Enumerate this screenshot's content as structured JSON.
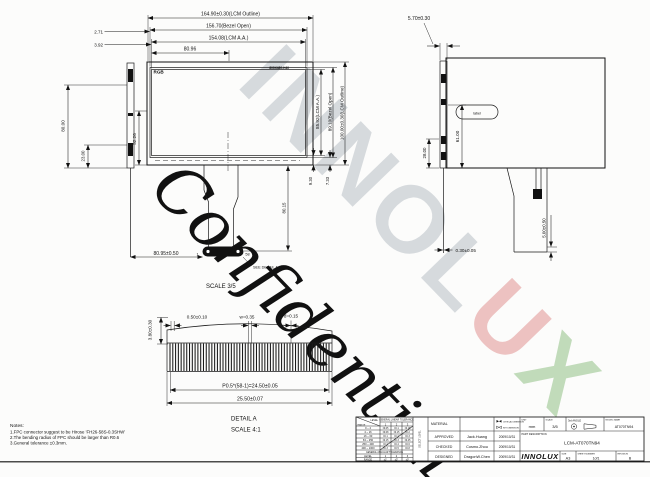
{
  "watermark": {
    "logo_part1": "INNOL",
    "logo_part2": "U",
    "logo_part3": "X",
    "confidential": "Confidential",
    "gray": "rgba(158,168,178,0.40)",
    "red": "rgba(210,85,85,0.35)",
    "green": "rgba(105,170,90,0.40)",
    "cyan": "rgba(92,170,202,0.55)"
  },
  "front_view": {
    "rgb_label": "RGB",
    "corner_marking": "800X480-H40",
    "dim_outline_w": "164.90±0.30(LCM Outline)",
    "dim_bezel_w": "156.70(Bezel Open)",
    "dim_aa_w": "154.08(LCM A.A.)",
    "dim_center": "80.96",
    "dim_bezel_left": "2.71",
    "dim_aa_left": "3.92",
    "dim_aa_h": "85.92(LCM A.A.)",
    "dim_bezel_h": "89.10(Bezel Open)",
    "dim_outline_h": "100.00±0.30(LCM Outline)",
    "dim_aa_bottom": "9.30",
    "dim_bezel_bottom": "7.33",
    "dim_left_v": "52.26",
    "dim_fpc_x": "80.95±0.50",
    "dim_fpc_len": "80.15",
    "pin_first": "1",
    "pin_last": "58",
    "see_detail": "SEE DETAIL A",
    "scale_note": "SCALE  3/5"
  },
  "side_left": {
    "dim_height": "80.00",
    "dim_lower": "23.00"
  },
  "side_right": {
    "dim_thickness": "5.70±0.30",
    "dim_upper": "61.00",
    "dim_lower": "28.00",
    "dim_fpc_t": "0.30±0.05"
  },
  "rear_view": {
    "badge_text": "label",
    "dim_fpc_bottom": "5.00±0.50"
  },
  "detail_a": {
    "pin_count": 58,
    "dim_height": "3.80±0.30",
    "dim_first": "0.50±0.10",
    "dim_width": "w=0.35",
    "dim_gap": "d=0.15",
    "dim_pitch": "P0.5*(58-1)=24.50±0.05",
    "dim_total": "25.50±0.07",
    "title": "DETAIL  A",
    "scale_note": "SCALE  4:1"
  },
  "notes": {
    "title": "Notes:",
    "lines": [
      "1.FPC connector suggest to be Hirose 'FH26-58S-0.3SHW'",
      "2.The bending radius of FPC should be larger than R0.6",
      "3.General tolerance ±0.3mm."
    ]
  },
  "title_block": {
    "material_label": "MATERIAL",
    "critical_label": "CRITICAL DIMENSION",
    "key_label": "KEY DIMENSION",
    "rows": [
      {
        "role": "APPROVED",
        "name": "Jack.Huang",
        "date": "2009/10/31"
      },
      {
        "role": "CHECKED",
        "name": "Cosmo.Zhou",
        "date": "2009/10/31"
      },
      {
        "role": "DESIGNED",
        "name": "DragonW.Chen",
        "date": "2009/10/31"
      }
    ],
    "unit_label": "UNIT",
    "unit_value": "mm",
    "scale_label": "SCALE",
    "scale_value": "3/5",
    "angle_label": "3rd ANGLE",
    "model_label": "MODEL NAME",
    "model_value": "AT070TN94",
    "part_desc_label": "PART DESCRIPTION",
    "part_desc_value": "LCM-AT070TN94",
    "logo_text": "INNOLUX",
    "size_label": "SIZE",
    "size_value": "A3",
    "sheet_label": "SHEET NUMBER",
    "sheet_value": "1of1",
    "rev_label": "REVISION",
    "rev_value": "B",
    "tolerance_table": {
      "corner_top": "LEVEL",
      "corner_bottom": "RANGE",
      "linear_header": "GENERAL LINEAR TOLERANCE",
      "select_label": "SELECT LEVEL",
      "col_headers": [
        "1",
        "2",
        "3"
      ],
      "rows": [
        {
          "range": "0 ~ 4",
          "v": [
            "±0.05",
            "±0.1",
            "±0.15"
          ]
        },
        {
          "range": "4 ~ 16",
          "v": [
            "±0.08",
            "±0.15",
            "±0.2"
          ]
        },
        {
          "range": "16 ~ 63",
          "v": [
            "±0.1",
            "±0.2",
            "±0.3"
          ]
        },
        {
          "range": "63 ~ 250",
          "v": [
            "±0.15",
            "±0.3",
            "±0.45"
          ]
        },
        {
          "range": "250 ~ 400",
          "v": [
            "±0.2",
            "±0.4",
            "±0.6"
          ]
        },
        {
          "range": "400 ~ 1000",
          "v": [
            "±0.3",
            "±0.5",
            "±0.8"
          ]
        }
      ],
      "angular_header": "GENERAL ANGULAR TOLERANCE",
      "angular_level_label": "LEVEL",
      "angular_range_label": "RANGE",
      "angular_levels": [
        "1",
        "2",
        "3"
      ],
      "angular_values": [
        "±1°",
        "±2°",
        "±3°"
      ]
    }
  }
}
